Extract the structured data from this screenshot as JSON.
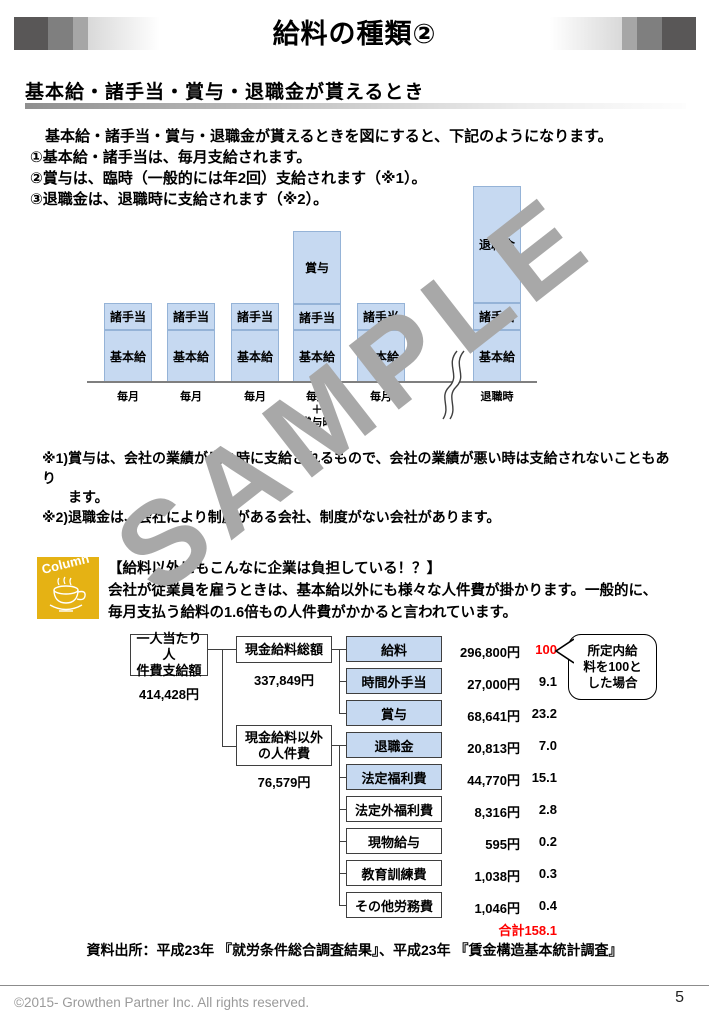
{
  "header": {
    "title": "給料の種類②"
  },
  "section": {
    "heading": "基本給・諸手当・賞与・退職金が貰えるとき"
  },
  "intro": {
    "line1": "　基本給・諸手当・賞与・退職金が貰えるときを図にすると、下記のようになります。",
    "line2": "①基本給・諸手当は、毎月支給されます。",
    "line3": "②賞与は、臨時（一般的には年2回）支給されます（※1）。",
    "line4": "③退職金は、退職時に支給されます（※2）。"
  },
  "chart_data": {
    "type": "bar",
    "stacked": true,
    "title": "",
    "xlabel": "",
    "ylabel": "",
    "grid": false,
    "categories": [
      "毎月",
      "毎月",
      "毎月",
      "毎月＋賞与時",
      "毎月",
      "退職時"
    ],
    "series": [
      {
        "name": "基本給",
        "values": [
          52,
          52,
          52,
          52,
          52,
          52
        ]
      },
      {
        "name": "諸手当",
        "values": [
          27,
          27,
          27,
          26,
          27,
          27
        ]
      },
      {
        "name": "賞与",
        "values": [
          0,
          0,
          0,
          73,
          0,
          0
        ]
      },
      {
        "name": "退職金",
        "values": [
          0,
          0,
          0,
          0,
          0,
          117
        ]
      }
    ],
    "value_unit": "schematic segment heights in px (diagram has no numeric axis)",
    "axis_break_after_category_index": 4,
    "bar_fill": "#c6d9f1",
    "bar_border": "#95b3d7",
    "bonus_xlabel_lines": [
      "毎月",
      "＋",
      "賞与時"
    ]
  },
  "notes": {
    "line1": "※1)賞与は、会社の業績が良い時に支給されるもので、会社の業績が悪い時は支給されないこともあり",
    "line2": "ます。",
    "line3": "※2)退職金は、会社により制度がある会社、制度がない会社があります。"
  },
  "column": {
    "icon_label": "Column",
    "heading": "【給料以外にもこんなに企業は負担している！？】",
    "line1": "会社が従業員を雇うときは、基本給以外にも様々な人件費が掛かります。一般的に、",
    "line2": "毎月支払う給料の1.6倍もの人件費がかかると言われています。"
  },
  "tree": {
    "root": {
      "line1": "一人当たり人",
      "line2": "件費支給額",
      "value": "414,428円"
    },
    "branch_cash": {
      "label": "現金給料総額",
      "value": "337,849円"
    },
    "branch_noncash": {
      "line1": "現金給料以外",
      "line2": "の人件費",
      "value": "76,579円"
    },
    "rows": [
      {
        "label": "給料",
        "value": "296,800円",
        "index": "100"
      },
      {
        "label": "時間外手当",
        "value": "27,000円",
        "index": "9.1"
      },
      {
        "label": "賞与",
        "value": "68,641円",
        "index": "23.2"
      },
      {
        "label": "退職金",
        "value": "20,813円",
        "index": "7.0"
      },
      {
        "label": "法定福利費",
        "value": "44,770円",
        "index": "15.1"
      },
      {
        "label": "法定外福利費",
        "value": "8,316円",
        "index": "2.8"
      },
      {
        "label": "現物給与",
        "value": "595円",
        "index": "0.2"
      },
      {
        "label": "教育訓練費",
        "value": "1,038円",
        "index": "0.3"
      },
      {
        "label": "その他労務費",
        "value": "1,046円",
        "index": "0.4"
      }
    ],
    "total": "合計158.1",
    "bubble": {
      "line1": "所定内給",
      "line2": "料を100と",
      "line3": "した場合"
    }
  },
  "source": "資料出所：平成23年 『就労条件総合調査結果』、平成23年 『賃金構造基本統計調査』",
  "footer": {
    "copyright": "©2015- Growthen Partner Inc. All rights reserved.",
    "page_number": "5"
  },
  "watermark": "SAMPLE",
  "colors": {
    "bar_fill": "#c6d9f1",
    "bar_border": "#95b3d7",
    "column_yellow": "#e5b214",
    "red": "#ff0000"
  }
}
